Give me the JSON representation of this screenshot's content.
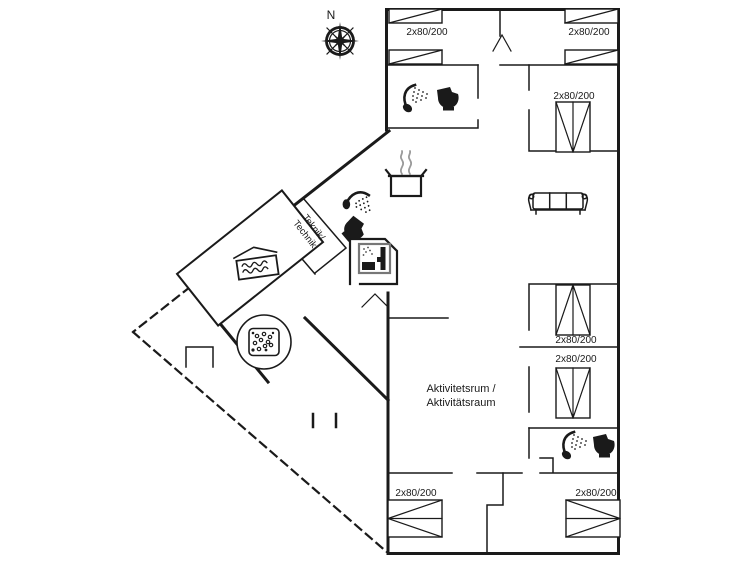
{
  "compass": {
    "north_label": "N"
  },
  "rooms": {
    "teknik_line1": "Teknik/",
    "teknik_line2": "Technik",
    "activity_line1": "Aktivitetsrum /",
    "activity_line2": "Aktivitätsraum"
  },
  "beds": {
    "labels": [
      "2x80/200",
      "2x80/200",
      "2x80/200",
      "2x80/200",
      "2x80/200",
      "2x80/200",
      "2x80/200"
    ]
  },
  "icons": {
    "compass": "compass-rose",
    "shower": "shower",
    "toilet": "toilet",
    "sauna": "sauna",
    "pool": "pool",
    "whirlpool": "whirlpool-tub",
    "sofa": "sofa",
    "stove": "cooking-pot-with-steam",
    "single_bed": "single-bed",
    "bunk_bed": "bunk-bed"
  },
  "colors": {
    "wall": "#1a1a1a",
    "steam": "#9a9a9a",
    "sauna_frame": "#777777",
    "background": "#ffffff"
  }
}
